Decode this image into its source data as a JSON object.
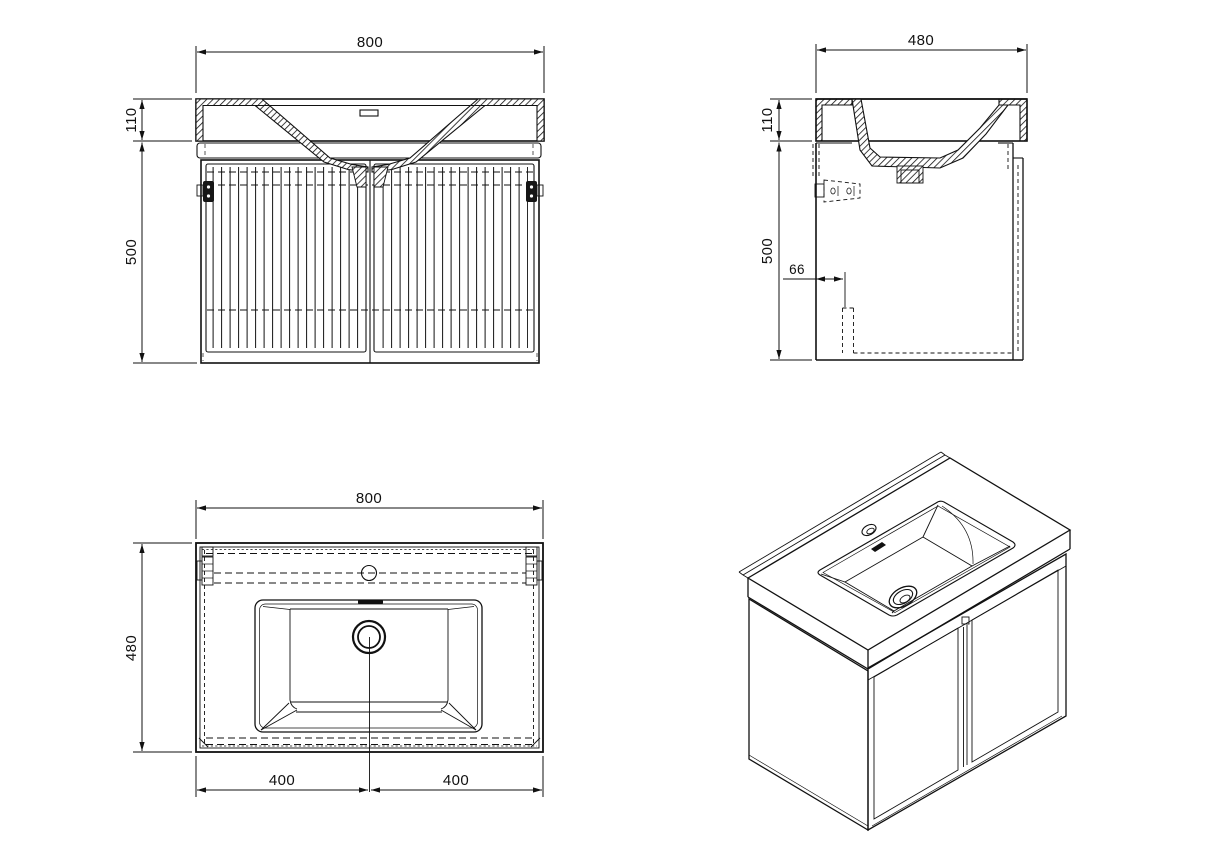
{
  "drawing": {
    "background": "#ffffff",
    "line_color": "#111111",
    "front": {
      "width": "800",
      "top_height": "110",
      "cabinet_height": "500"
    },
    "side": {
      "depth": "480",
      "top_height": "110",
      "cabinet_height": "500",
      "bracket_offset": "66"
    },
    "top": {
      "width": "800",
      "depth": "480",
      "left_half": "400",
      "right_half": "400"
    }
  }
}
